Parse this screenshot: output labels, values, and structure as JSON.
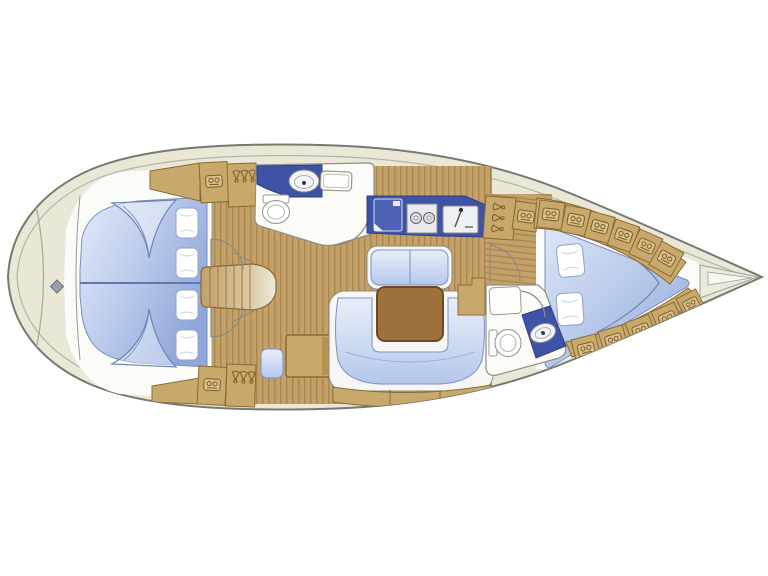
{
  "diagram": {
    "kind": "sailboat-interior-floor-plan",
    "orientation": {
      "bow": "right",
      "stern": "left"
    },
    "colors": {
      "background": "#ffffff",
      "hull_cream": "#eae7d6",
      "hull_stroke": "#75796f",
      "deck_line": "#b2b5a6",
      "interior_white": "#fbfbf7",
      "wood": "#c3a168",
      "wood_stripe": "#aa874e",
      "furniture_tan": "#c9a96b",
      "furniture_border": "#8a6a33",
      "counter_blue": "#3f53a6",
      "cushion_light": "#dfe8f7",
      "cushion_deep": "#9db3e0",
      "cushion_border": "#7b90c4",
      "table_brown": "#9e713c",
      "table_border": "#6b4a1f",
      "fixture_stroke": "#8f9088"
    },
    "areas": [
      {
        "name": "stern-deck",
        "features": [
          "transom-curve",
          "cleat-symbol"
        ]
      },
      {
        "name": "aft-cabin-upper",
        "features": [
          "double-berth",
          "pillows"
        ],
        "pillow_count": 2
      },
      {
        "name": "aft-cabin-lower",
        "features": [
          "double-berth",
          "pillows"
        ],
        "pillow_count": 2
      },
      {
        "name": "companionway-steps",
        "step_count": 6
      },
      {
        "name": "aft-head",
        "features": [
          "counter",
          "washbasin",
          "toilet",
          "hatch-window",
          "door"
        ]
      },
      {
        "name": "galley",
        "features": [
          "fridge",
          "two-burner-stove",
          "sink"
        ]
      },
      {
        "name": "salon",
        "features": [
          "bench-settee",
          "dining-table",
          "u-shaped-settee",
          "locker-strip"
        ]
      },
      {
        "name": "nav-station",
        "features": [
          "chart-table",
          "seat"
        ]
      },
      {
        "name": "hanging-lockers",
        "count": 3,
        "hanger_icons_per_locker": 3
      },
      {
        "name": "storage-locker-row-top",
        "cell_count": 6
      },
      {
        "name": "storage-locker-row-bottom",
        "cell_count": 5
      },
      {
        "name": "forward-head",
        "features": [
          "shower-bench",
          "toilet",
          "counter",
          "washbasin",
          "door"
        ]
      },
      {
        "name": "v-berth-cabin",
        "features": [
          "v-berth",
          "pillows",
          "door"
        ],
        "pillow_count": 2
      },
      {
        "name": "bow-anchor-locker",
        "features": [
          "converging-deck-lines"
        ]
      }
    ]
  }
}
